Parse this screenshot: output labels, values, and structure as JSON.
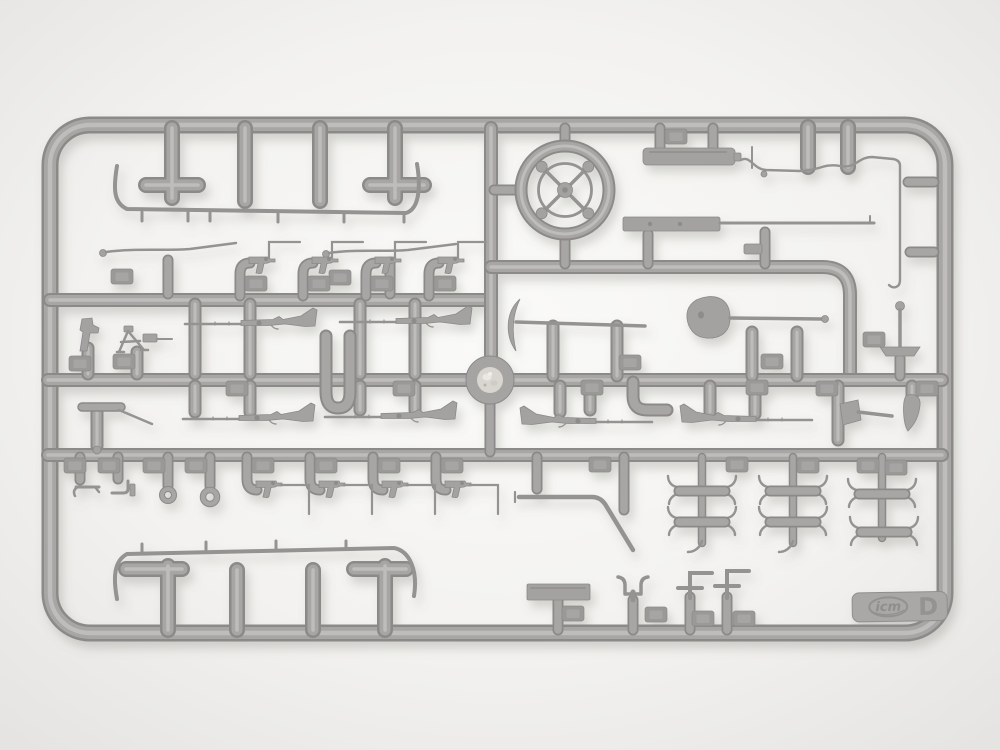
{
  "scene": {
    "type": "photograph",
    "subject": "gray injection-molded plastic model-kit sprue (parts runner) on a bright neutral background",
    "background_color": "#f3f2f0",
    "plastic_color": "#a6a5a3",
    "plastic_shadow_color": "#8b8a88",
    "plastic_highlight_color": "#c2c1bf",
    "tab": {
      "brand": "icm",
      "sprue_letter": "D"
    },
    "parts": [
      "long curved thin rod with molded gates (top left)",
      "cleaning rod with ball end (x2)",
      "pistol with wire shoulder stock (x4, upper row)",
      "spoked steering wheel",
      "rectangular stowage box",
      "long control wire linkage (top right)",
      "rifle with flat stock and long barrel",
      "cylindrical stub part (x2)",
      "bolt-action rifle (x6)",
      "pickaxe",
      "shovel with spade head",
      "T-handle jack",
      "hatchet",
      "pistol holster",
      "standing revolver",
      "bipod",
      "entrenching tool with rod",
      "hook fitting",
      "spout fitting",
      "ring-pull handle (x2)",
      "pistol with wire stock (x4, lower row)",
      "bent gear-lever rod",
      "cross clamp piece with hooked ends (x6 in 3 clusters)",
      "flat rectangular base plate",
      "U-shaped bracket",
      "L-shaped bracket (x2)",
      "long curved thin rod with molded gates (bottom left)",
      "central injection-point disc",
      "embossed part-number tags",
      "ICM logo tab with sprue letter"
    ]
  }
}
